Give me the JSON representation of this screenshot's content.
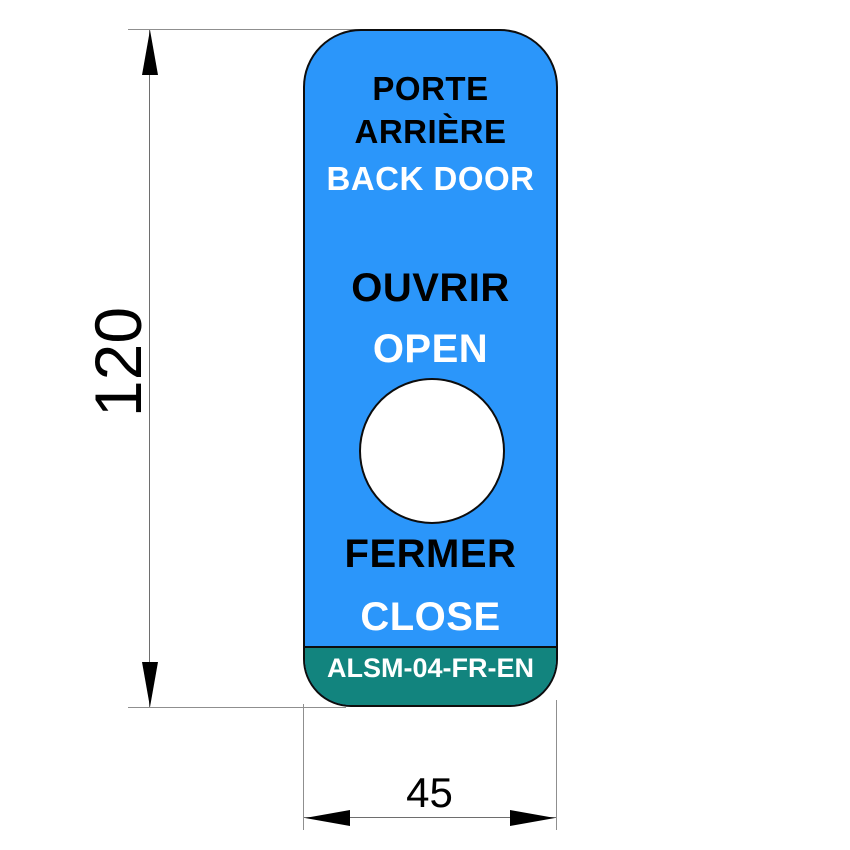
{
  "label": {
    "line_fr_1": "PORTE",
    "line_fr_2": "ARRIÈRE",
    "line_en_1": "BACK DOOR",
    "open_fr": "OUVRIR",
    "open_en": "OPEN",
    "close_fr": "FERMER",
    "close_en": "CLOSE",
    "part_number": "ALSM-04-FR-EN"
  },
  "dimensions": {
    "height_mm": "120",
    "width_mm": "45"
  },
  "colors": {
    "label_blue": "#2B96FA",
    "band_teal": "#12847E",
    "text_black": "#000000",
    "text_white": "#FFFFFF",
    "outline_black": "#0D0D0D"
  }
}
